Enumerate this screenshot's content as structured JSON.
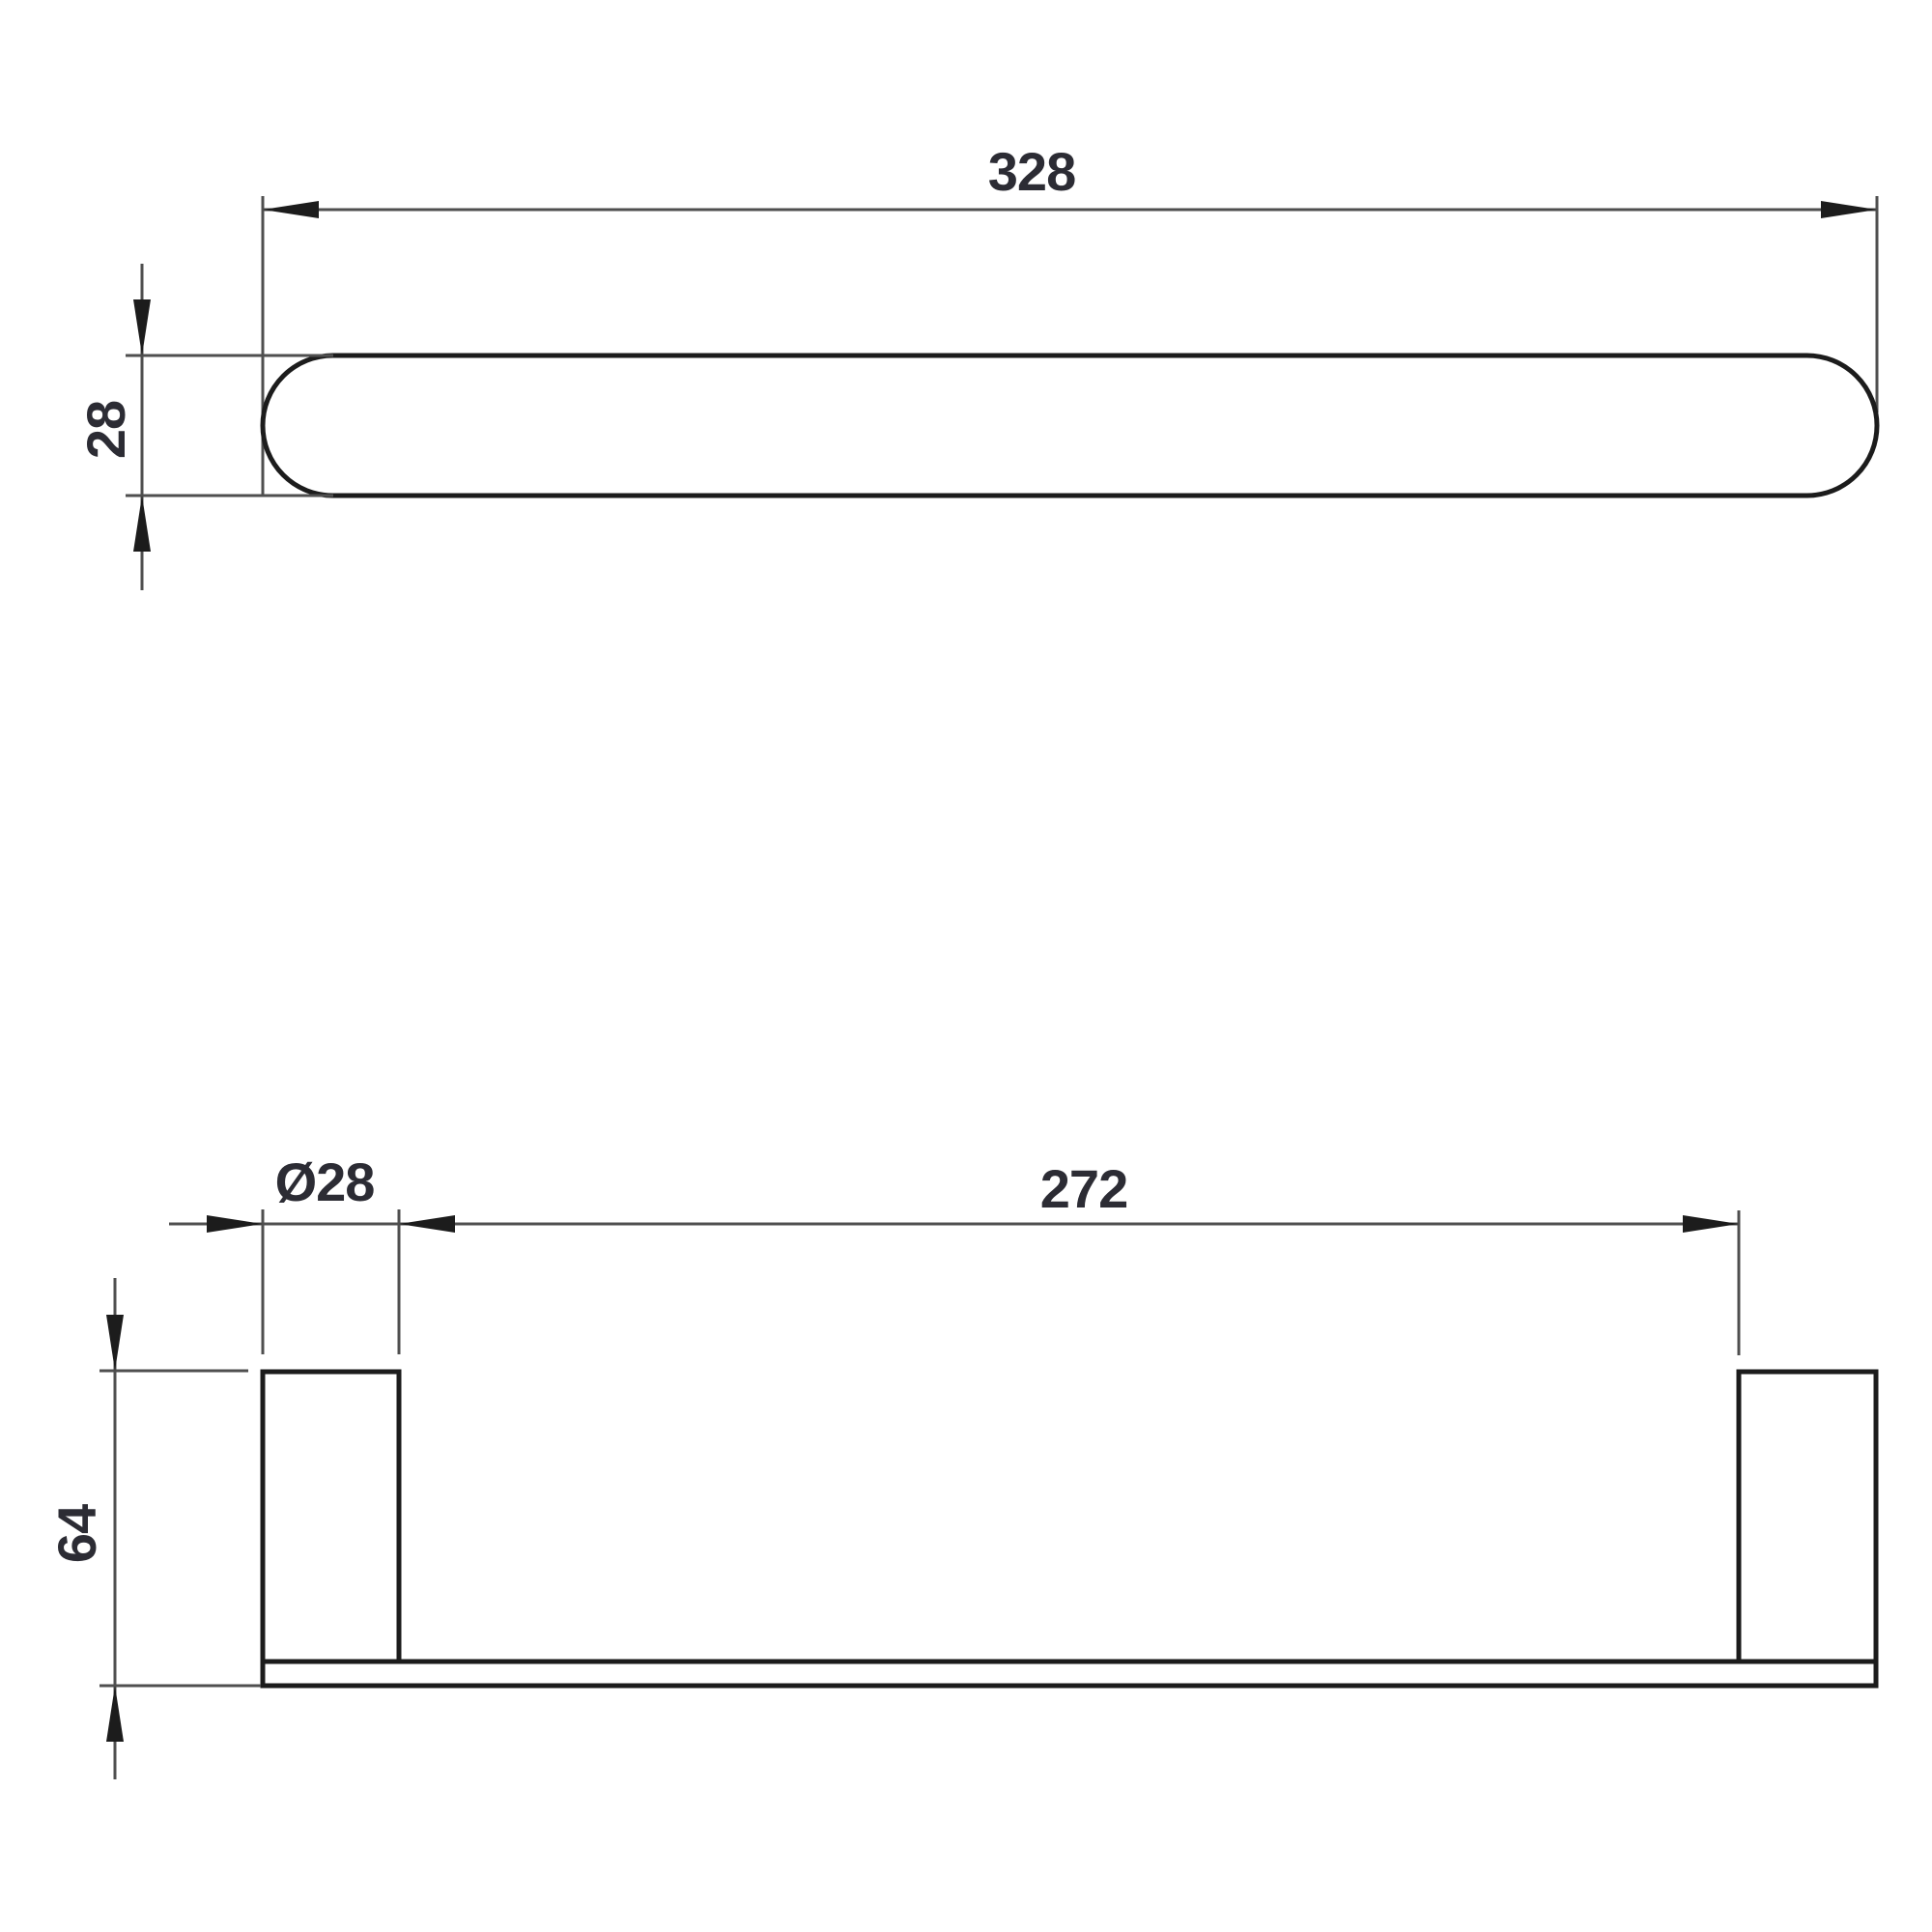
{
  "colors": {
    "background": "#ffffff",
    "object_line": "#1c1c1c",
    "dimension_line": "#4f4f4f",
    "label_text": "#2c2c34"
  },
  "top_view": {
    "dim_overall_length": {
      "label": "328"
    },
    "dim_bar_thickness": {
      "label": "28"
    }
  },
  "front_view": {
    "dim_post_diameter": {
      "label": "Ø28"
    },
    "dim_inner_span": {
      "label": "272"
    },
    "dim_mount_height": {
      "label": "64"
    }
  }
}
